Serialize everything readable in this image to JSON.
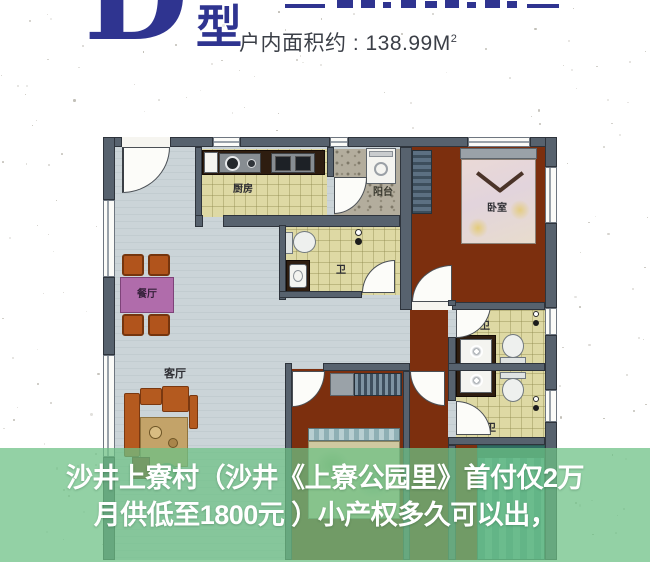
{
  "header": {
    "unit_type_letter": "D",
    "unit_type_suffix": "型",
    "area_text": "户内面积约 : 138.99M",
    "area_superscript": "2"
  },
  "floorplan": {
    "labels": {
      "kitchen": "厨房",
      "balcony": "阳台",
      "bedroom": "卧室",
      "bath": "卫",
      "dining": "餐厅",
      "living": "客厅"
    }
  },
  "banner": {
    "line1": "沙井上寮村（沙井《上寮公园里》首付仅2万",
    "line2": "月供低至1800元 ）小产权多久可以出，"
  },
  "colors": {
    "accent_navy": "#2f3490",
    "banner_green": "#6dc185",
    "banner_text": "#ffffff",
    "floor_blue": "#c8d1d5",
    "floor_yellow": "#ded9a4",
    "floor_maroon": "#7c2f0e",
    "wall_gray": "#57626e"
  }
}
